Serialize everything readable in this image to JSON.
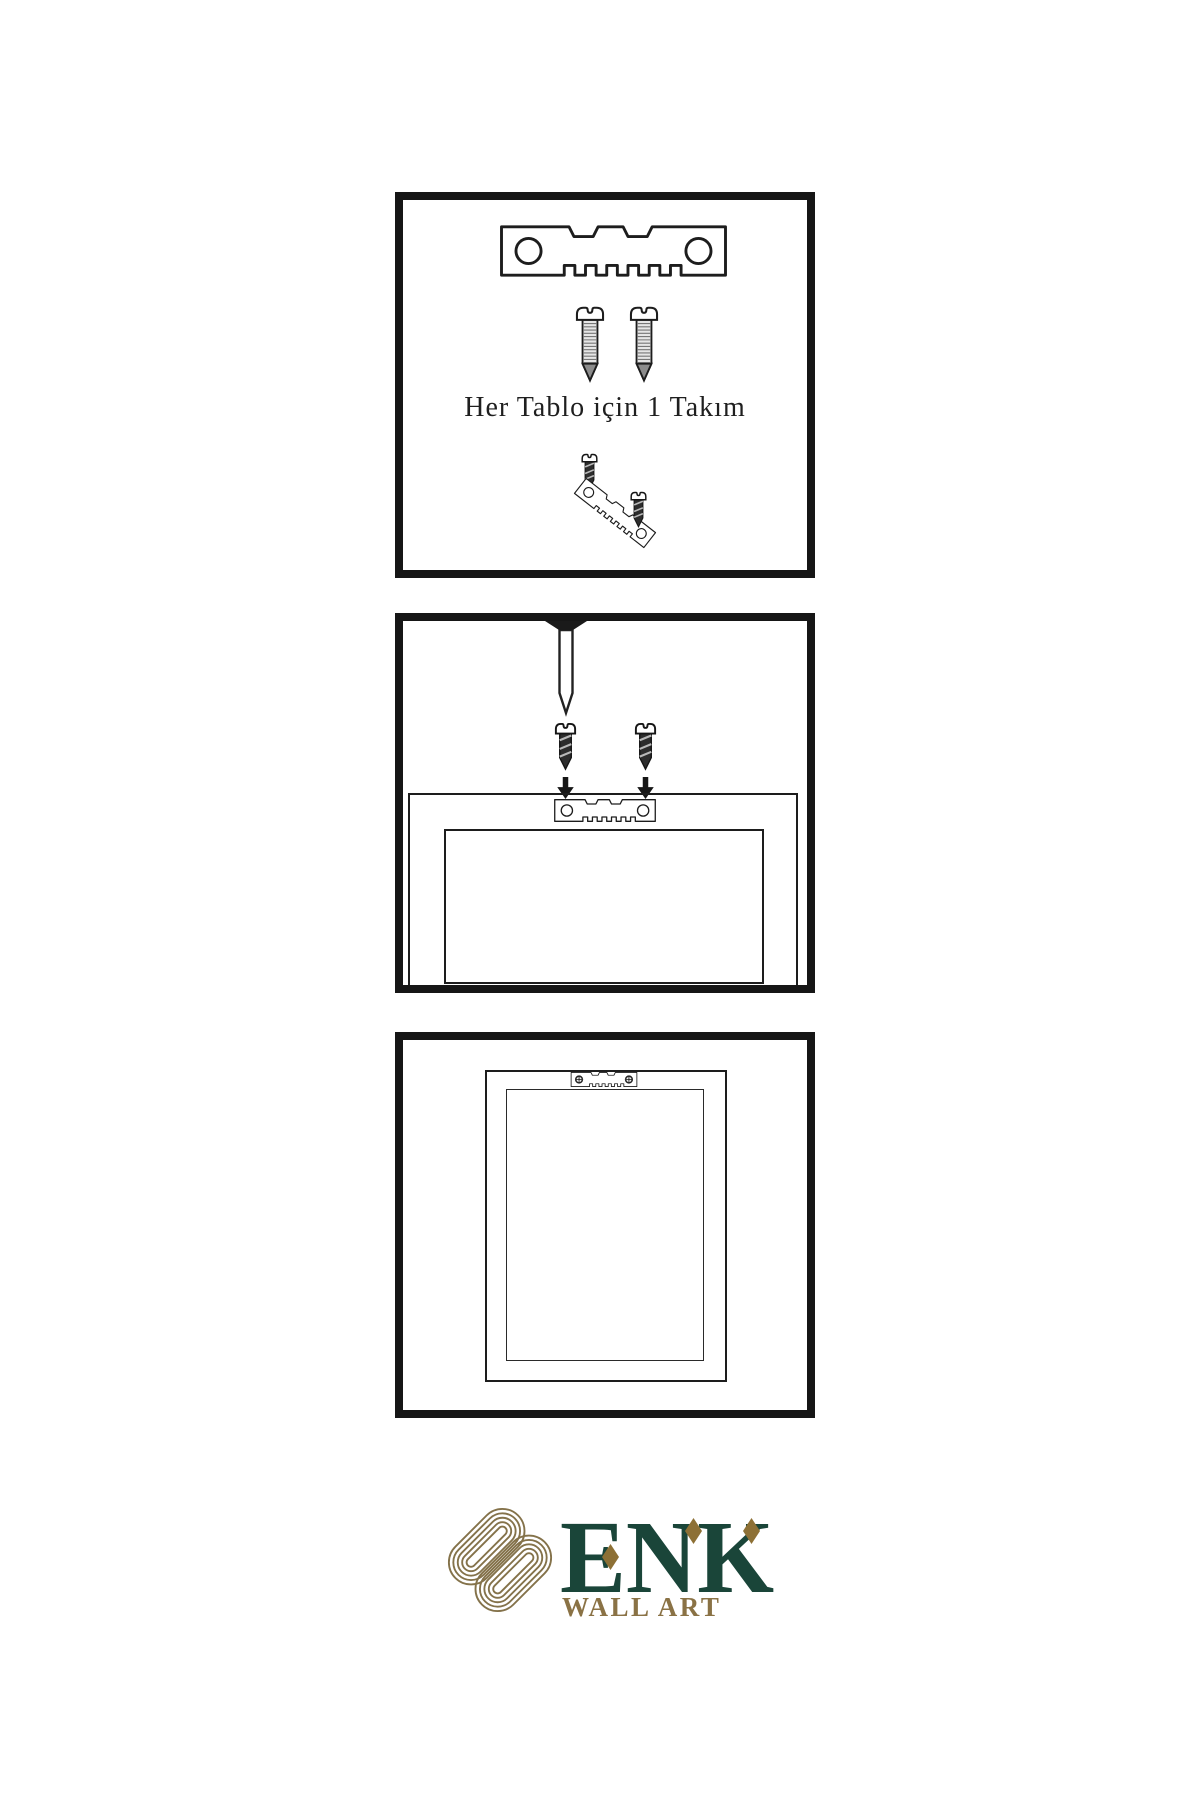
{
  "panels": [
    {
      "id": "hardware-set",
      "caption": "Her Tablo için 1 Takım",
      "items": [
        "sawtooth-hanger",
        "screw",
        "screw",
        "screw-into-angled-hanger"
      ]
    },
    {
      "id": "mounting-step",
      "caption": "",
      "items": [
        "wall-nail",
        "screw",
        "screw",
        "down-arrow",
        "down-arrow",
        "frame-back-with-hanger"
      ]
    },
    {
      "id": "hung-frame",
      "caption": "",
      "items": [
        "frame-back-hanging-with-screwed-hanger"
      ]
    }
  ],
  "logo": {
    "brand": "ENK",
    "subtitle": "WALL ART",
    "colors": {
      "brand_green": "#1a4539",
      "gold": "#8a7245",
      "knot_gold": "#84724a"
    }
  }
}
